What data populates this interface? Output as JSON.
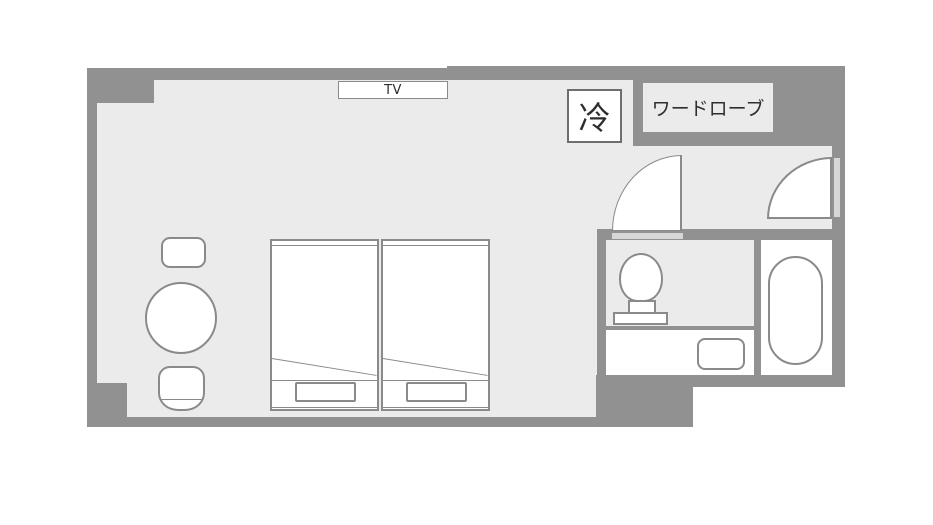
{
  "floorplan": {
    "type": "hotel-guestroom-floorplan",
    "labels": {
      "tv": "TV",
      "fridge": "冷",
      "wardrobe": "ワードローブ"
    },
    "colors": {
      "page": "#ffffff",
      "wall": "#919191",
      "floor": "#ebebeb",
      "line": "#8a8a8a",
      "fill": "#ffffff",
      "threshold": "#d6d6d6",
      "box-border": "#6e6e6e",
      "text": "#2e2e2e"
    }
  }
}
